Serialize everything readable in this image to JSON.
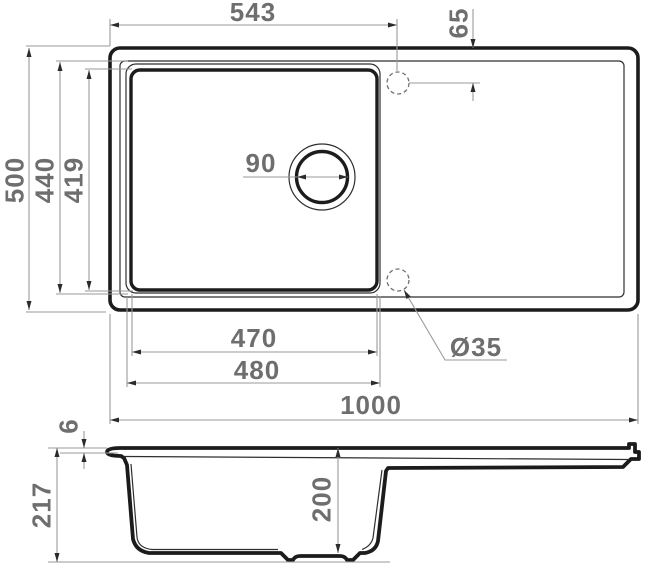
{
  "title": "Kitchen sink technical drawing — top and side section views",
  "colors": {
    "bg": "#ffffff",
    "outline": "#1c1c1c",
    "thin": "#2e2e2e",
    "dim": "#9a9a9a",
    "dashed": "#6f6f6f",
    "arrow": "#2b2b2b",
    "label": "#6e6e6e"
  },
  "top_view": {
    "dims": {
      "tap_hole_offset_x": "543",
      "tap_hole_offset_y": "65",
      "overall_width": "500",
      "bowl_rim_width": "440",
      "bowl_inner_width": "419",
      "drain_diameter": "90",
      "bowl_inner_length": "470",
      "bowl_rim_length": "480",
      "overall_length": "1000",
      "tap_hole_diameter": "Ø35"
    }
  },
  "side_view": {
    "dims": {
      "rim_lip_height": "6",
      "overall_height": "217",
      "bowl_depth": "200"
    }
  }
}
